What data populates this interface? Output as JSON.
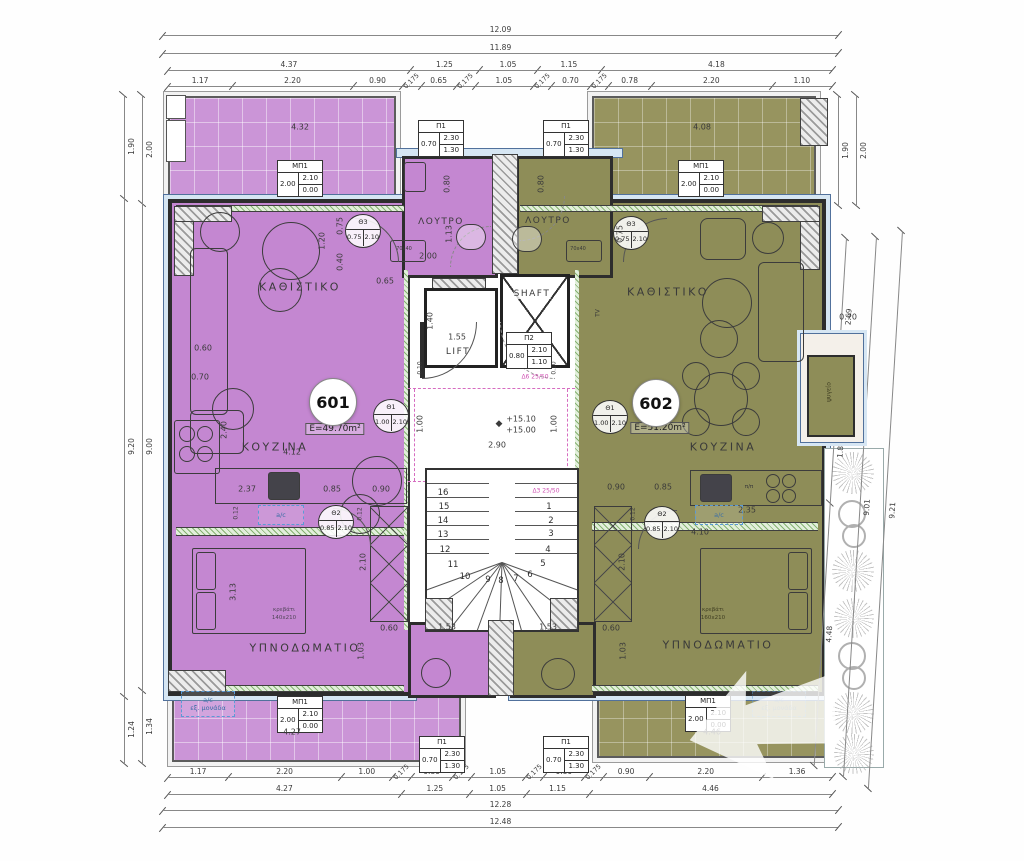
{
  "plan": {
    "apartments": [
      {
        "id": "601",
        "area": "E=49.70m²",
        "living": "ΚΑΘΙΣΤΙΚΟ",
        "kitchen": "ΚΟΥΖΙΝΑ",
        "bedroom": "ΥΠΝΟΔΩΜΑΤΙΟ",
        "bath": "ΛΟΥΤΡΟ"
      },
      {
        "id": "602",
        "area": "E=51.20m²",
        "living": "ΚΑΘΙΣΤΙΚΟ",
        "kitchen": "ΚΟΥΖΙΝΑ",
        "bedroom": "ΥΠΝΟΔΩΜΑΤΙΟ",
        "bath": "ΛΟΥΤΡΟ"
      }
    ],
    "core": {
      "lift": "LIFT",
      "shaft": "SHAFT"
    },
    "labels": {
      "ac": "a/c",
      "ac_ext1": "a/c",
      "ac_ext2": "εξ. μονάδα",
      "level_upper": "+15.10",
      "level_lower": "+15.00",
      "level_mark": "◆"
    },
    "schedules": {
      "P1": {
        "name": "Π1",
        "w": "0.70",
        "h": "2.30",
        "sill": "1.30"
      },
      "P2": {
        "name": "Π2",
        "w": "0.80",
        "h": "2.10",
        "sill": "1.10"
      },
      "MP1": {
        "name": "ΜΠ1",
        "w": "2.00",
        "h": "2.10",
        "sill": "0.00"
      },
      "TH1": {
        "name": "Θ1",
        "w": "1.00",
        "h": "2.10"
      },
      "TH2": {
        "name": "Θ2",
        "w": "0.85",
        "h": "2.10"
      },
      "TH3": {
        "name": "Θ3",
        "w": "0.75",
        "h": "2.10"
      }
    }
  },
  "dims": {
    "top": [
      [
        "12.09"
      ],
      [
        "11.89"
      ],
      [
        "4.37",
        "1.25",
        "1.05",
        "1.15",
        "4.18"
      ],
      [
        "1.17",
        "2.20",
        "0.90",
        "0.175",
        "0.65",
        "0.175",
        "1.05",
        "0.175",
        "0.70",
        "0.175",
        "0.78",
        "2.20",
        "1.10"
      ]
    ],
    "bottom": [
      [
        "1.17",
        "2.20",
        "1.00",
        "0.175",
        "0.80",
        "0.175",
        "1.05",
        "0.175",
        "0.80",
        "0.175",
        "0.90",
        "2.20",
        "1.36"
      ],
      [
        "4.27",
        "1.25",
        "1.05",
        "1.15",
        "4.46"
      ],
      [
        "12.28"
      ],
      [
        "12.48"
      ]
    ],
    "left_outer": [
      "1.90",
      "9.20",
      "1.24"
    ],
    "left_inner": [
      "2.00",
      "9.00",
      "1.34"
    ],
    "right_top_outer": [
      "1.90"
    ],
    "right_top_inner": [
      "2.00"
    ],
    "right_inner": [
      "2.69",
      "1.84",
      "4.48"
    ],
    "right_mid": [
      "9.01"
    ],
    "right_outer": [
      "9.21"
    ]
  },
  "plan_labels": [
    {
      "t": "4.32",
      "x": 300,
      "y": 127
    },
    {
      "t": "4.08",
      "x": 702,
      "y": 127
    },
    {
      "t": "1.20",
      "x": 322,
      "y": 241,
      "r": 1
    },
    {
      "t": "0.75",
      "x": 340,
      "y": 226,
      "r": 1
    },
    {
      "t": "0.40",
      "x": 340,
      "y": 262,
      "r": 1
    },
    {
      "t": "0.65",
      "x": 385,
      "y": 281
    },
    {
      "t": "0.80",
      "x": 447,
      "y": 184,
      "r": 1
    },
    {
      "t": "0.80",
      "x": 541,
      "y": 184,
      "r": 1
    },
    {
      "t": "1.13",
      "x": 449,
      "y": 234,
      "r": 1
    },
    {
      "t": "0.75",
      "x": 620,
      "y": 234,
      "r": 1
    },
    {
      "t": "2.00",
      "x": 428,
      "y": 256
    },
    {
      "t": "70x40",
      "x": 404,
      "y": 249,
      "fs": 5
    },
    {
      "t": "70x40",
      "x": 578,
      "y": 249,
      "fs": 5
    },
    {
      "t": "0.60",
      "x": 203,
      "y": 348
    },
    {
      "t": "0.70",
      "x": 200,
      "y": 377
    },
    {
      "t": "2.40",
      "x": 224,
      "y": 430,
      "r": 1
    },
    {
      "t": "4.12",
      "x": 292,
      "y": 452
    },
    {
      "t": "2.37",
      "x": 247,
      "y": 489
    },
    {
      "t": "0.85",
      "x": 332,
      "y": 489
    },
    {
      "t": "0.90",
      "x": 381,
      "y": 489
    },
    {
      "t": "0.90",
      "x": 616,
      "y": 487
    },
    {
      "t": "0.85",
      "x": 663,
      "y": 487
    },
    {
      "t": "2.35",
      "x": 747,
      "y": 510
    },
    {
      "t": "4.10",
      "x": 700,
      "y": 532
    },
    {
      "t": "3.13",
      "x": 233,
      "y": 592,
      "r": 1
    },
    {
      "t": "2.10",
      "x": 363,
      "y": 562,
      "r": 1
    },
    {
      "t": "2.10",
      "x": 622,
      "y": 562,
      "r": 1
    },
    {
      "t": "0.60",
      "x": 389,
      "y": 628
    },
    {
      "t": "0.60",
      "x": 611,
      "y": 628
    },
    {
      "t": "1.03",
      "x": 361,
      "y": 651,
      "r": 1
    },
    {
      "t": "1.03",
      "x": 623,
      "y": 651,
      "r": 1
    },
    {
      "t": "1.53",
      "x": 447,
      "y": 627
    },
    {
      "t": "1.53",
      "x": 548,
      "y": 627
    },
    {
      "t": "4.27",
      "x": 292,
      "y": 732
    },
    {
      "t": "4.46",
      "x": 712,
      "y": 732
    },
    {
      "t": "1.55",
      "x": 457,
      "y": 337
    },
    {
      "t": "1.40",
      "x": 430,
      "y": 321,
      "r": 1
    },
    {
      "t": "2.90",
      "x": 497,
      "y": 445
    },
    {
      "t": "1.00",
      "x": 420,
      "y": 424,
      "r": 1
    },
    {
      "t": "1.00",
      "x": 554,
      "y": 424,
      "r": 1
    },
    {
      "t": "0.10",
      "x": 420,
      "y": 368,
      "r": 1,
      "fs": 6
    },
    {
      "t": "0.10",
      "x": 554,
      "y": 368,
      "r": 1,
      "fs": 6
    },
    {
      "t": "0.12",
      "x": 236,
      "y": 513,
      "r": 1,
      "fs": 6
    },
    {
      "t": "0.12",
      "x": 360,
      "y": 514,
      "r": 1,
      "fs": 6
    },
    {
      "t": "0.12",
      "x": 633,
      "y": 514,
      "r": 1,
      "fs": 6
    },
    {
      "t": "0.70",
      "x": 848,
      "y": 317
    },
    {
      "t": "κρεβάτι",
      "x": 284,
      "y": 610,
      "fs": 5.5,
      "c": "#52455a"
    },
    {
      "t": "140x210",
      "x": 284,
      "y": 618,
      "fs": 5.5,
      "c": "#52455a"
    },
    {
      "t": "κρεβάτι",
      "x": 713,
      "y": 610,
      "fs": 5.5,
      "c": "#3f3e22"
    },
    {
      "t": "160x210",
      "x": 713,
      "y": 618,
      "fs": 5.5,
      "c": "#3f3e22"
    },
    {
      "t": "Δ6 25/50",
      "x": 535,
      "y": 377,
      "fs": 6,
      "c": "#cf4fb2"
    },
    {
      "t": "Δ3 25/50",
      "x": 546,
      "y": 491,
      "fs": 6,
      "c": "#cf4fb2"
    },
    {
      "t": "TV",
      "x": 598,
      "y": 313,
      "r": 1,
      "fs": 6
    },
    {
      "t": "ψυγείο",
      "x": 829,
      "y": 392,
      "r": 1,
      "fs": 6,
      "c": "#3f3e22"
    },
    {
      "t": "π/π",
      "x": 749,
      "y": 487,
      "fs": 5.5
    }
  ],
  "stairs": {
    "steps": [
      {
        "n": "16",
        "x": 443,
        "y": 493
      },
      {
        "n": "15",
        "x": 444,
        "y": 507
      },
      {
        "n": "14",
        "x": 443,
        "y": 521
      },
      {
        "n": "13",
        "x": 443,
        "y": 535
      },
      {
        "n": "12",
        "x": 445,
        "y": 550
      },
      {
        "n": "11",
        "x": 453,
        "y": 565
      },
      {
        "n": "10",
        "x": 465,
        "y": 577
      },
      {
        "n": "9",
        "x": 488,
        "y": 580
      },
      {
        "n": "8",
        "x": 501,
        "y": 581
      },
      {
        "n": "7",
        "x": 516,
        "y": 579
      },
      {
        "n": "6",
        "x": 530,
        "y": 575
      },
      {
        "n": "5",
        "x": 543,
        "y": 564
      },
      {
        "n": "4",
        "x": 548,
        "y": 550
      },
      {
        "n": "3",
        "x": 551,
        "y": 534
      },
      {
        "n": "2",
        "x": 551,
        "y": 521
      },
      {
        "n": "1",
        "x": 549,
        "y": 507
      }
    ]
  }
}
